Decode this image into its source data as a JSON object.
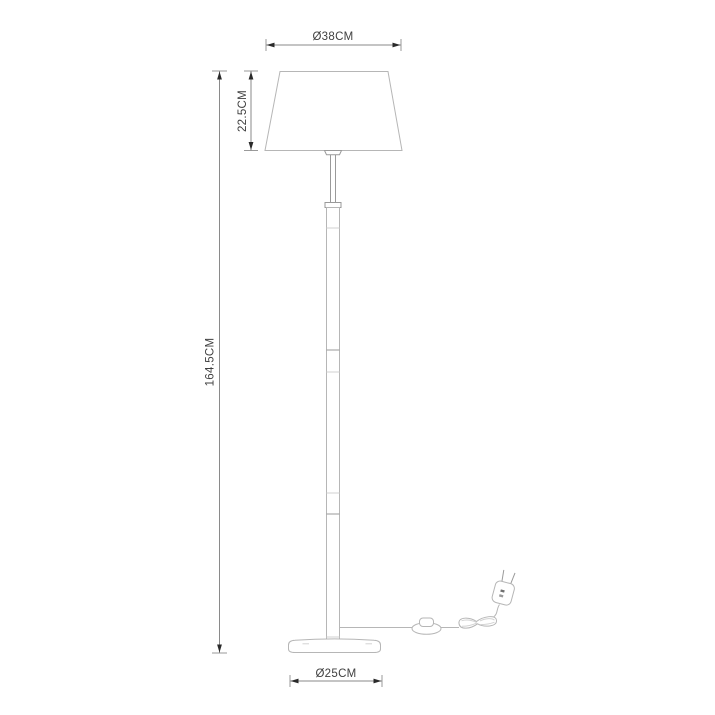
{
  "diagram": {
    "type": "product-dimension-drawing",
    "subject": "floor lamp",
    "labels": {
      "shade_diameter": "Ø38CM",
      "shade_height": "22.5CM",
      "lamp_height": "164.5CM",
      "base_diameter": "Ø25CM"
    },
    "colors": {
      "background": "#ffffff",
      "outline": "#b6b6b6",
      "outline_dark": "#9a9a9a",
      "outline_light": "#d2d2d2",
      "dimension_line": "#8a8a8a",
      "tick": "#9a9a9a",
      "arrow": "#2a2a2a",
      "text": "#3f3f3f"
    }
  }
}
